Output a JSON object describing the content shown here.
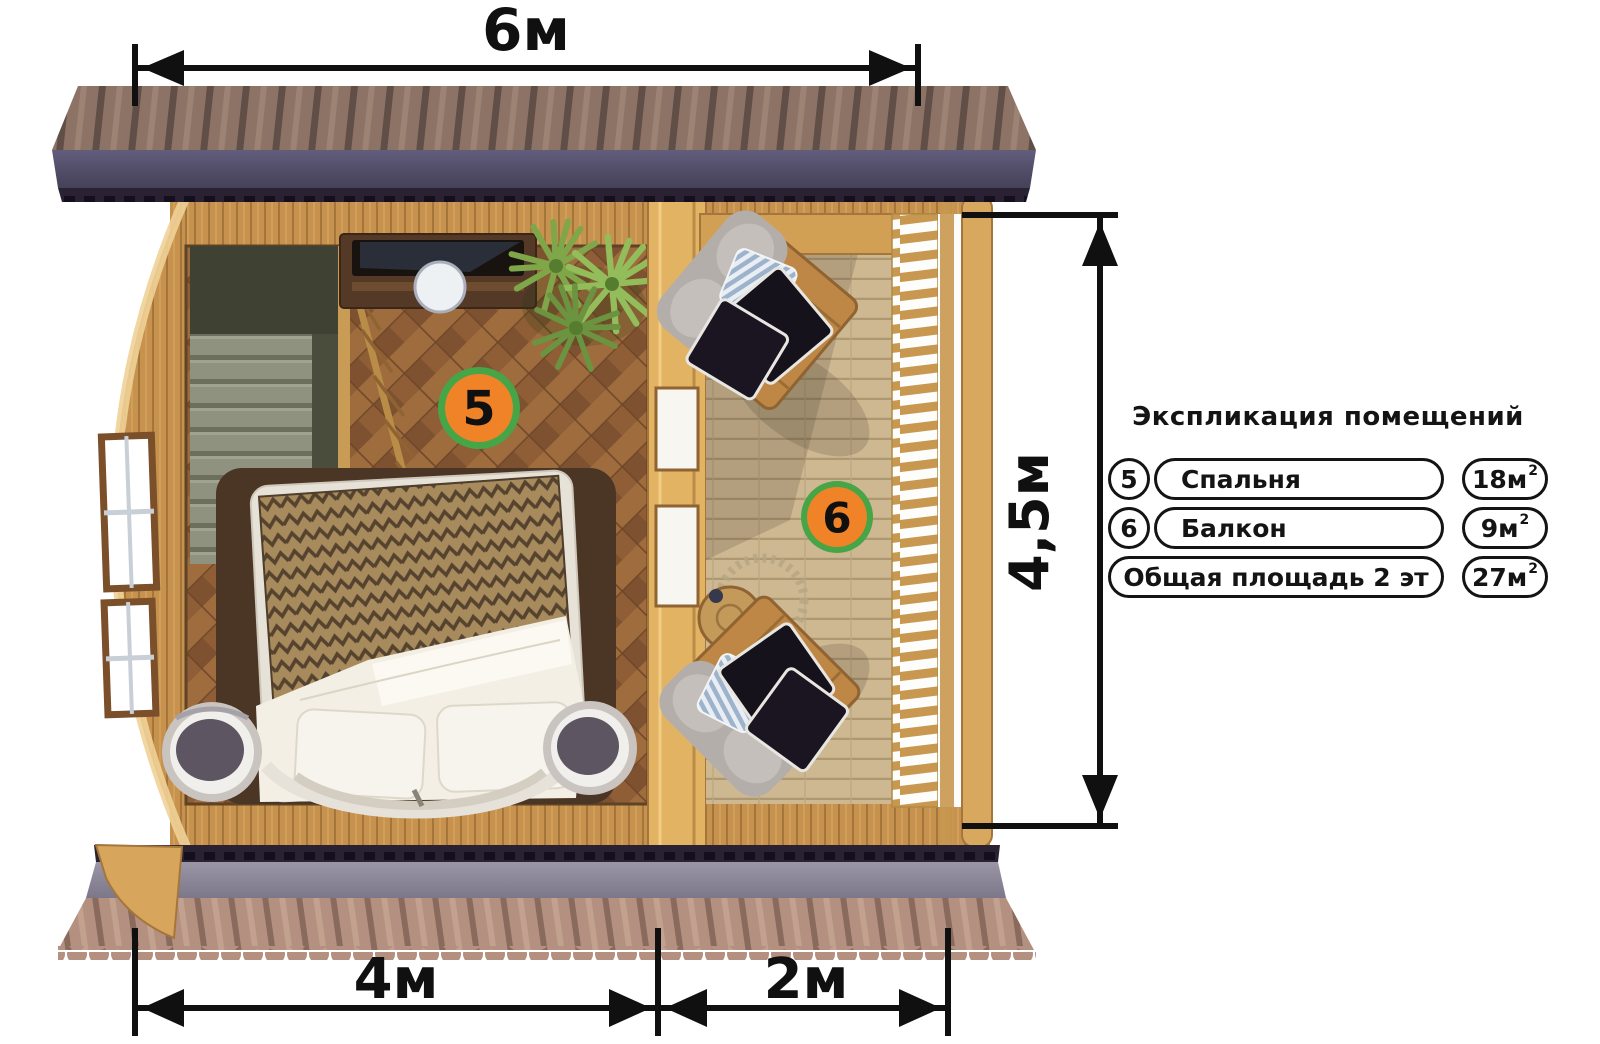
{
  "plan": {
    "dimensions": {
      "total_width": "6м",
      "total_depth": "4,5м",
      "bedroom_width": "4м",
      "balcony_width": "2м"
    },
    "room_markers": [
      {
        "number": "5"
      },
      {
        "number": "6"
      }
    ]
  },
  "legend": {
    "title": "Экспликация помещений",
    "rows": [
      {
        "num": "5",
        "name": "Спальня",
        "area": "18м",
        "area_sup": "2"
      },
      {
        "num": "6",
        "name": "Балкон",
        "area": "9м",
        "area_sup": "2"
      },
      {
        "num": "",
        "name": "Общая площадь 2 эт",
        "area": "27м",
        "area_sup": "2"
      }
    ]
  },
  "colors": {
    "marker_fill": "#F08228",
    "marker_ring": "#46A546",
    "dimension": "#101010",
    "legend_border": "#141414"
  }
}
